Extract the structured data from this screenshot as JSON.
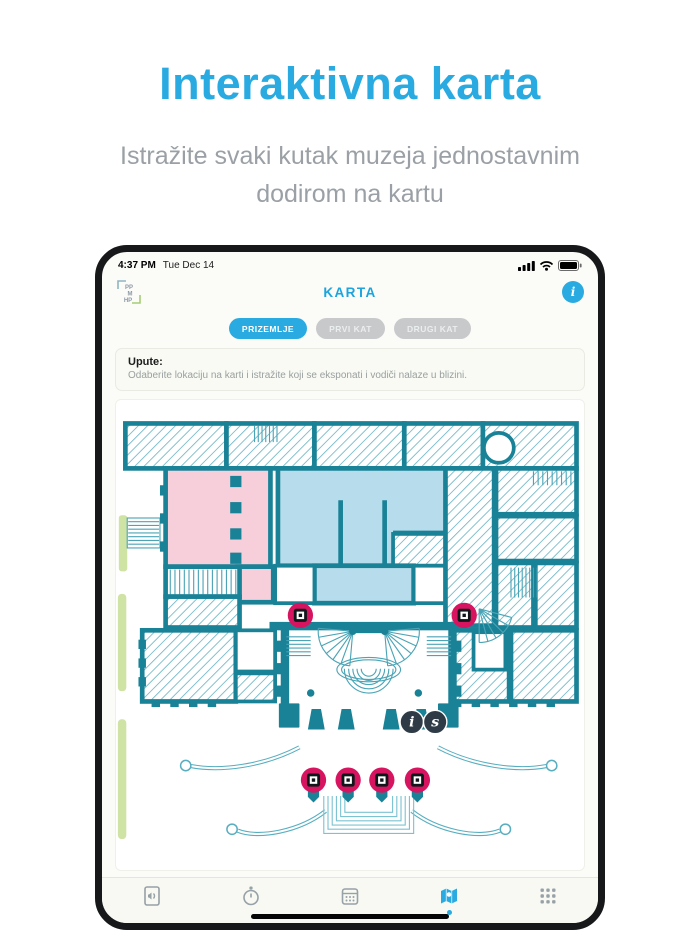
{
  "hero": {
    "title": "Interaktivna karta",
    "subtitle": "Istražite svaki kutak muzeja jednostavnim dodirom na kartu"
  },
  "device": {
    "status_bar": {
      "time": "4:37 PM",
      "date": "Tue Dec 14",
      "icons": [
        "signal-icon",
        "wifi-icon",
        "battery-icon"
      ]
    },
    "header": {
      "title": "KARTA",
      "logo_lines": [
        "PP",
        "M",
        "HP"
      ],
      "info_label": "i"
    },
    "tabs": [
      {
        "label": "PRIZEMLJE",
        "active": true
      },
      {
        "label": "PRVI KAT",
        "active": false
      },
      {
        "label": "DRUGI KAT",
        "active": false
      }
    ],
    "instructions": {
      "title": "Upute:",
      "body": "Odaberite lokaciju na karti i istražite koji se eksponati i vodiči nalaze u blizini."
    },
    "map": {
      "colors": {
        "marker": "#d6145f",
        "badge": "#2e3b46",
        "wall": "#1a8296",
        "room_pink": "#f7cfda",
        "room_blue": "#b7dcec",
        "green": "#cfe3a5"
      },
      "qr_markers": [
        {
          "x": 197,
          "y": 219
        },
        {
          "x": 372,
          "y": 219
        },
        {
          "x": 211,
          "y": 395
        },
        {
          "x": 248,
          "y": 395
        },
        {
          "x": 284,
          "y": 395
        },
        {
          "x": 322,
          "y": 395
        }
      ],
      "letter_markers": [
        {
          "label": "i",
          "x": 316,
          "y": 333
        },
        {
          "label": "s",
          "x": 341,
          "y": 333
        }
      ]
    },
    "tab_bar": {
      "items": [
        {
          "name": "audio-guide",
          "active": false
        },
        {
          "name": "history-watch",
          "active": false
        },
        {
          "name": "events-calendar",
          "active": false
        },
        {
          "name": "map",
          "active": true
        },
        {
          "name": "more-grid",
          "active": false
        }
      ]
    }
  },
  "colors": {
    "accent_blue": "#29abe2",
    "heading_blue": "#29abe2",
    "subtitle_gray": "#9aa0a5"
  }
}
